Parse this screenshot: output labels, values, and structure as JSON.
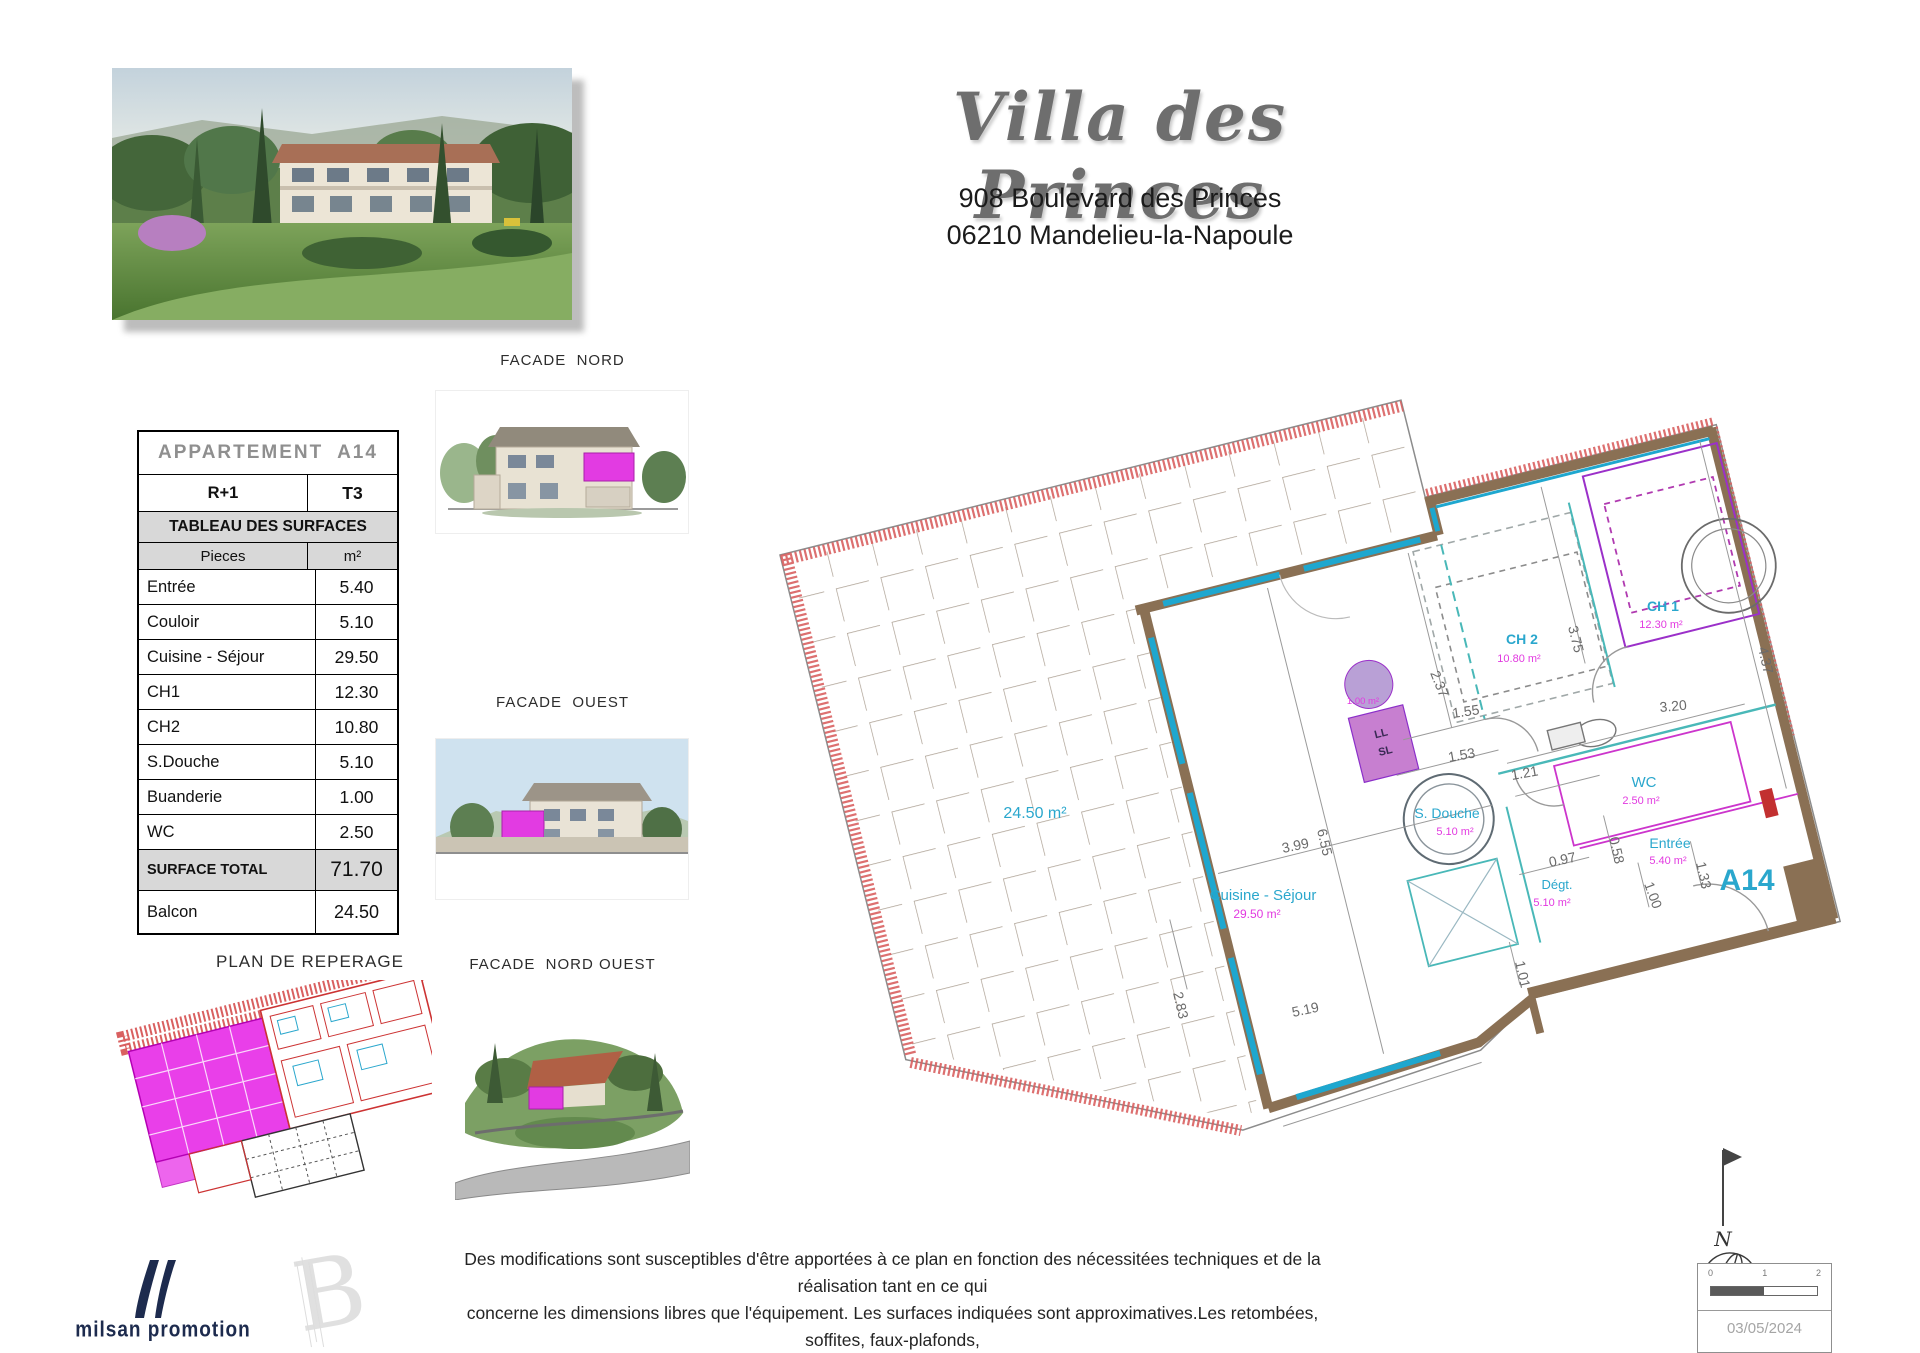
{
  "header": {
    "title": "Villa des Princes",
    "address_line1": "908 Boulevard des Princes",
    "address_line2": "06210 Mandelieu-la-Napoule"
  },
  "surface_table": {
    "title": "APPARTEMENT  A14",
    "level": "R+1",
    "apt_type": "T3",
    "section": "TABLEAU DES SURFACES",
    "col_rooms": "Pieces",
    "col_unit": "m²",
    "rows": [
      {
        "label": "Entrée",
        "value": "5.40"
      },
      {
        "label": "Couloir",
        "value": "5.10"
      },
      {
        "label": "Cuisine - Séjour",
        "value": "29.50"
      },
      {
        "label": "CH1",
        "value": "12.30"
      },
      {
        "label": "CH2",
        "value": "10.80"
      },
      {
        "label": "S.Douche",
        "value": "5.10"
      },
      {
        "label": "Buanderie",
        "value": "1.00"
      },
      {
        "label": "WC",
        "value": "2.50"
      }
    ],
    "total_label": "SURFACE TOTAL",
    "total_value": "71.70",
    "balcon_label": "Balcon",
    "balcon_value": "24.50"
  },
  "sections": {
    "plan_reperage": "PLAN DE REPERAGE",
    "facade_nord": "FACADE  NORD",
    "facade_ouest": "FACADE  OUEST",
    "facade_nord_ouest": "FACADE  NORD OUEST"
  },
  "plan": {
    "unit": "A14",
    "balcony_area": "24.50 m²",
    "rooms": {
      "cuisine": {
        "name": "Cuisine - Séjour",
        "area": "29.50 m²"
      },
      "ch1": {
        "name": "CH 1",
        "area": "12.30 m²"
      },
      "ch2": {
        "name": "CH 2",
        "area": "10.80 m²"
      },
      "wc": {
        "name": "WC",
        "area": "2.50 m²"
      },
      "entree": {
        "name": "Entrée",
        "area": "5.40 m²"
      },
      "sdouche": {
        "name": "S. Douche",
        "area": "5.10 m²"
      },
      "degt": {
        "name": "Dégt.",
        "area": "5.10 m²"
      },
      "buanderie": {
        "area": "1.00 m²",
        "washer_top": "LL",
        "washer_bottom": "SL"
      }
    },
    "dims": {
      "d237": "2.37",
      "d375": "3.75",
      "d437": "4.37",
      "d155": "1.55",
      "d320": "3.20",
      "d153": "1.53",
      "d121": "1.21",
      "d655": "6.55",
      "d399": "3.99",
      "d097": "0.97",
      "d058": "0.58",
      "d133": "1.33",
      "d100": "1.00",
      "d283": "2.83",
      "d519": "5.19",
      "d101": "1.01"
    },
    "north": "N"
  },
  "footer": {
    "logo": "milsan promotion",
    "disclaimer1": "Des modifications sont susceptibles d'être apportées à ce plan en fonction des nécessitées techniques et de la réalisation tant en ce qui",
    "disclaimer2": "concerne les dimensions libres que l'équipement.  Les surfaces indiquées sont approximatives.Les retombées, soffites, faux-plafonds,",
    "disclaimer3": "canalisations, ainsi que les équipements ne figurent pas sur ce plan. Les plantations éventuelles ne sont pas contractuelles.",
    "scale": {
      "t0": "0",
      "t1": "1",
      "t2": "2"
    },
    "date": "03/05/2024"
  },
  "colors": {
    "plan_cyan": "#2aa7cd",
    "plan_magenta": "#e23ae0",
    "wall_brown": "#8a7054",
    "hatch_red": "#d96060",
    "dim_gray": "#6a6a6a"
  }
}
